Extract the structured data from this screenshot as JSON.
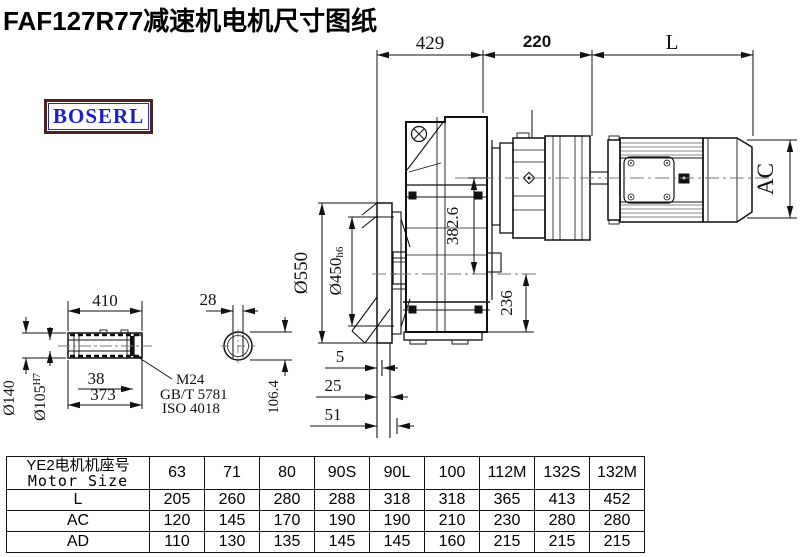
{
  "title": "FAF127R77减速机电机尺寸图纸",
  "logo": "BOSERL",
  "drawing": {
    "dims": {
      "top_429": "429",
      "top_220": "220",
      "top_L": "L",
      "od550": "Ø550",
      "spigot": "Ø450",
      "spigot_tol": "h6",
      "axis": "382.6",
      "foot": "236",
      "ac": "AC",
      "len410": "410",
      "key28": "28",
      "d140": "Ø140",
      "d105": "Ø105",
      "d105_tol": "H7",
      "n38": "38",
      "n373": "373",
      "m24": "M24",
      "gb": "GB/T 5781",
      "iso": "ISO 4018",
      "k106": "106.4",
      "s5": "5",
      "s25": "25",
      "s51": "51"
    }
  },
  "table": {
    "header_cn": "YE2电机机座号",
    "header_en": "Motor Size",
    "sizes": [
      "63",
      "71",
      "80",
      "90S",
      "90L",
      "100",
      "112M",
      "132S",
      "132M"
    ],
    "rows": [
      {
        "label": "L",
        "values": [
          "205",
          "260",
          "280",
          "288",
          "318",
          "318",
          "365",
          "413",
          "452"
        ]
      },
      {
        "label": "AC",
        "values": [
          "120",
          "145",
          "170",
          "190",
          "190",
          "210",
          "230",
          "280",
          "280"
        ]
      },
      {
        "label": "AD",
        "values": [
          "110",
          "130",
          "135",
          "145",
          "145",
          "160",
          "215",
          "215",
          "215"
        ]
      }
    ]
  },
  "colors": {
    "line": "#111111",
    "centerline": "#777777",
    "logo_text": "#2020c0",
    "logo_border": "#4a2420"
  }
}
